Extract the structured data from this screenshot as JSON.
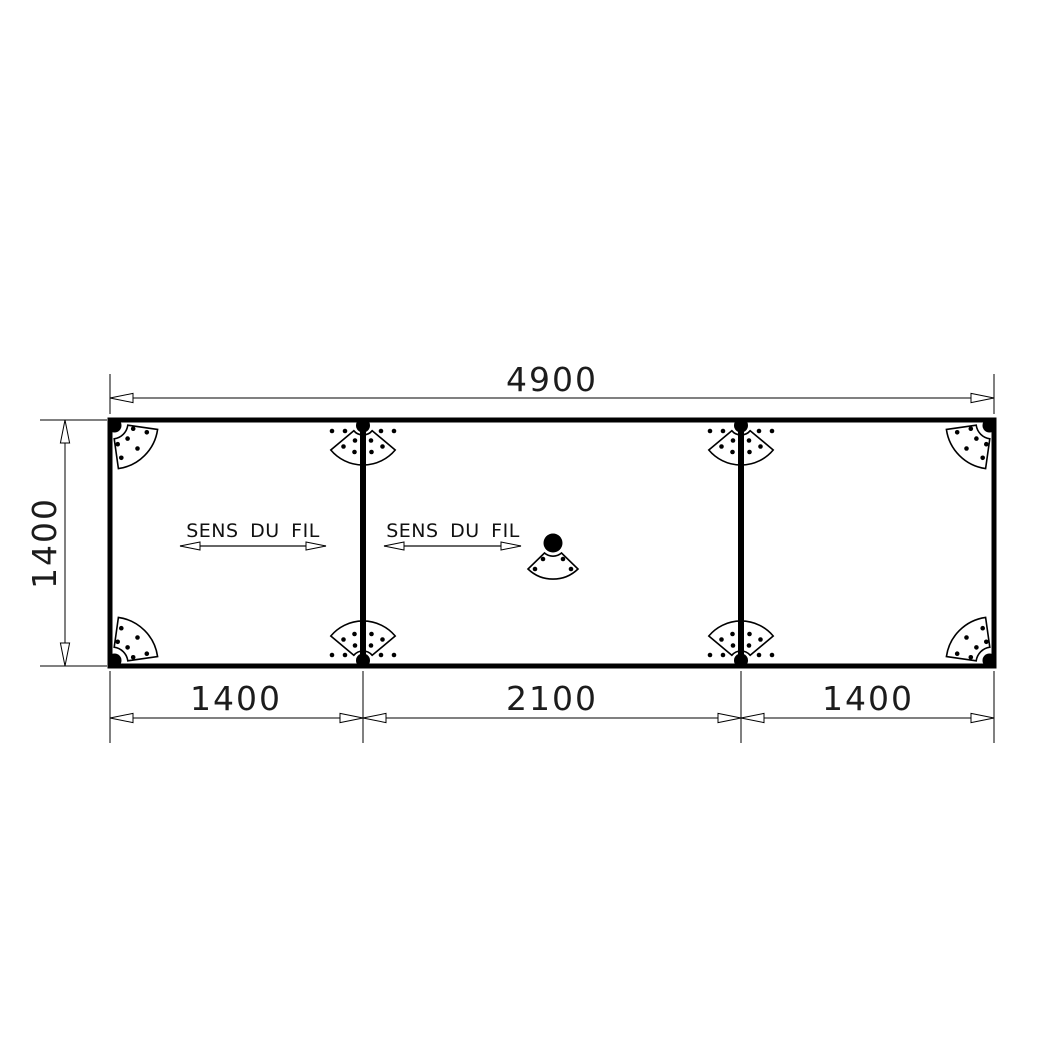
{
  "drawing": {
    "background": "#ffffff",
    "line_color": "#000000",
    "dimensions": {
      "overall_width": {
        "label": "4900"
      },
      "height": {
        "label": "1400"
      },
      "sections": [
        {
          "label": "1400"
        },
        {
          "label": "2100"
        },
        {
          "label": "1400"
        }
      ]
    },
    "grain_direction": [
      {
        "label": "SENS DU FIL"
      },
      {
        "label": "SENS DU FIL"
      }
    ]
  }
}
